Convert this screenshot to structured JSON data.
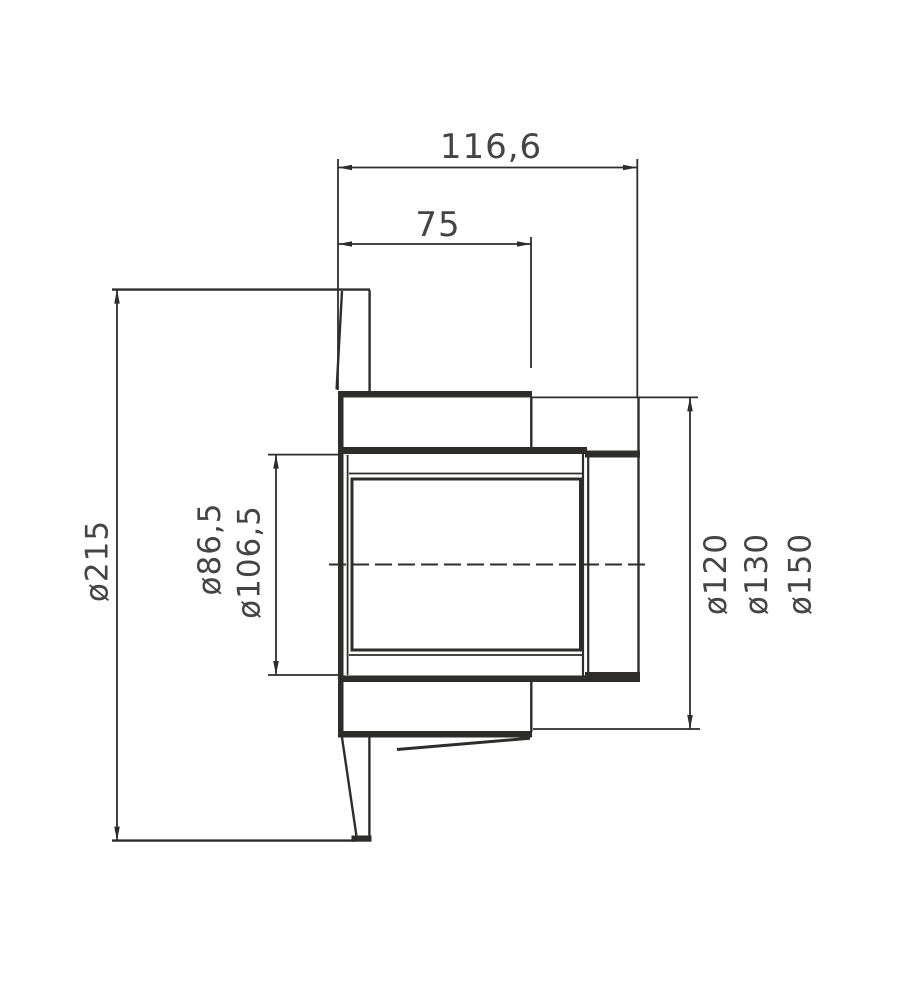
{
  "page": {
    "background_color": "#ffffff"
  },
  "drawing": {
    "line_color": "#2e2d2b",
    "text_color": "#454443",
    "dimensions": {
      "overall_depth": "116,6",
      "insertion_depth": "75",
      "plate_diameter": "ø215",
      "inner_diameter_1": "ø86,5",
      "inner_diameter_2": "ø106,5",
      "spigot_diameter_1": "ø120",
      "spigot_diameter_2": "ø130",
      "spigot_diameter_3": "ø150"
    }
  }
}
